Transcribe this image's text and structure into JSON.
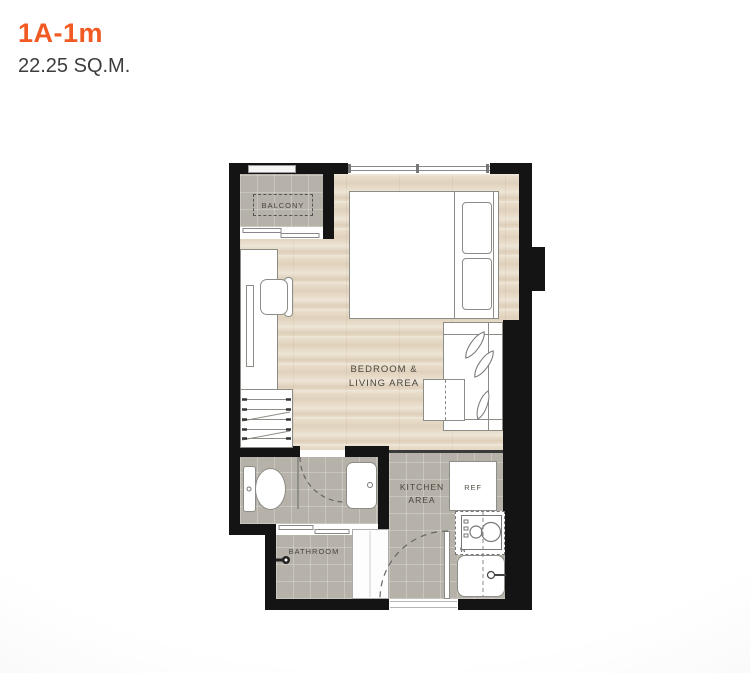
{
  "header": {
    "unit_name": "1A-1m",
    "area_label": "22.25 SQ.M."
  },
  "colors": {
    "accent_orange": "#F15A22",
    "wall_black": "#141414",
    "wood_floor": "#E8DCC9",
    "tile_gray": "#B6B2A9",
    "label_text": "#4A453D",
    "furniture_outline": "#8D8D87"
  },
  "floorplan": {
    "balcony_label": "BALCONY",
    "bedroom_label_line1": "BEDROOM &",
    "bedroom_label_line2": "LIVING AREA",
    "kitchen_label_line1": "KITCHEN",
    "kitchen_label_line2": "AREA",
    "bathroom_label": "BATHROOM",
    "ref_label": "REF",
    "washer_label": "W"
  }
}
